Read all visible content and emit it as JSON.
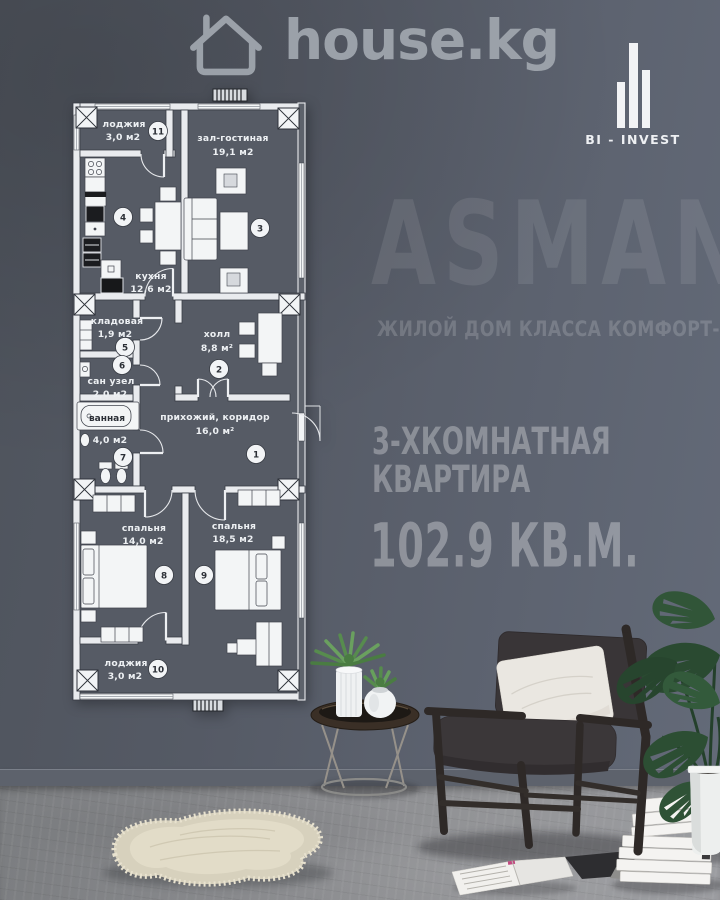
{
  "header": {
    "brand": "house.kg",
    "brand_icon": "house-icon"
  },
  "developer": {
    "label": "BI - INVEST",
    "logo_icon": "building-bars-icon"
  },
  "promo": {
    "project": "ASMAN",
    "tagline": "ЖИЛОЙ ДОМ КЛАССА КОМФОРТ-ПЛЮС",
    "type_line1": "3-ХКОМНАТНАЯ",
    "type_line2": "КВАРТИРА",
    "total_area": "102.9 КВ.М."
  },
  "floor_plan": {
    "rooms": [
      {
        "num": "1",
        "name": "прихожий, коридор",
        "area": "16,0 м²"
      },
      {
        "num": "2",
        "name": "холл",
        "area": "8,8 м²"
      },
      {
        "num": "3",
        "name": "зал-гостиная",
        "area": "19,1 м2"
      },
      {
        "num": "4",
        "name": "кухня",
        "area": "12,6 м2"
      },
      {
        "num": "5",
        "name": "кладовая",
        "area": "1,9 м2"
      },
      {
        "num": "6",
        "name": "сан узел",
        "area": "2,0 м2"
      },
      {
        "num": "7",
        "name": "ванная",
        "area": "4,0 м2"
      },
      {
        "num": "8",
        "name": "спальня",
        "area": "14,0 м2"
      },
      {
        "num": "9",
        "name": "спальня",
        "area": "18,5 м2"
      },
      {
        "num": "10",
        "name": "лоджия",
        "area": "3,0 м2"
      },
      {
        "num": "11",
        "name": "лоджия",
        "area": "3,0 м2"
      }
    ]
  },
  "colors": {
    "wall": "#575c66",
    "floor": "#8f9093",
    "plan_lines": "#e9ebee",
    "label_text": "#edf0f3"
  }
}
